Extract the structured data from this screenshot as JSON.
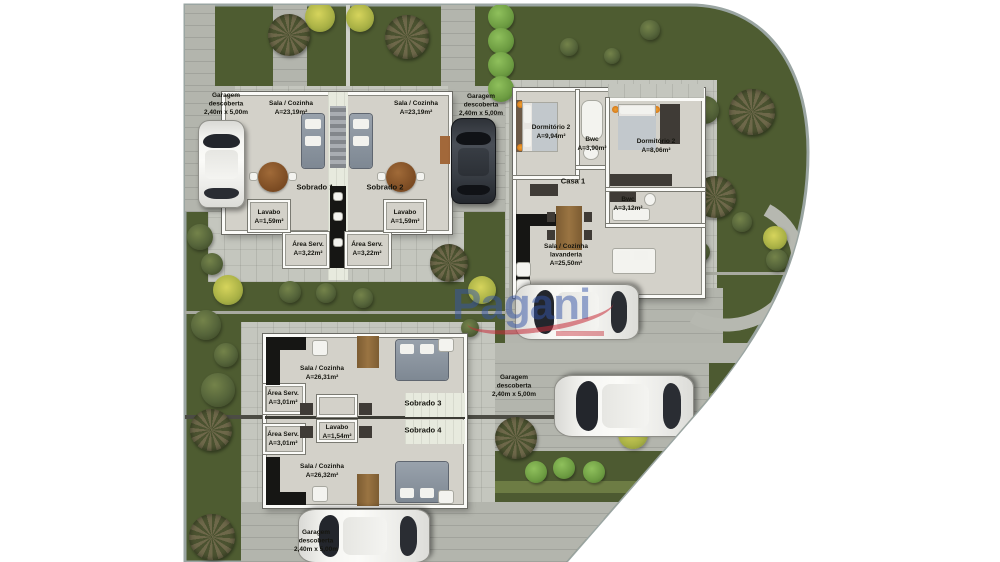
{
  "colors": {
    "lawn": "#4e5c31",
    "paving": "#c4c6be",
    "paving_dark": "#b3b5ad",
    "wall_white": "#fbfbf8",
    "counter_black": "#161614",
    "watermark_blue": "#3454a8",
    "watermark_red": "#c62c38"
  },
  "watermark": {
    "brand": "Pagani"
  },
  "garage_label": {
    "line1": "Garagem",
    "line2": "descoberta",
    "line3": "2,40m x 5,00m"
  },
  "top_building": {
    "unit1": {
      "name": "Sobrado 1",
      "room": "Sala / Cozinha",
      "room_area": "A=23,19m²",
      "lavabo": "Lavabo",
      "lavabo_area": "A=1,59m²",
      "service": "Área Serv.",
      "service_area": "A=3,22m²"
    },
    "unit2": {
      "name": "Sobrado 2",
      "room": "Sala / Cozinha",
      "room_area": "A=23,19m²",
      "lavabo": "Lavabo",
      "lavabo_area": "A=1,59m²",
      "service": "Área Serv.",
      "service_area": "A=3,22m²"
    }
  },
  "casa1": {
    "name": "Casa 1",
    "bedroom_left": {
      "room": "Dormitório 2",
      "area": "A=9,94m²"
    },
    "bathroom_top": {
      "room": "Bwc",
      "area": "A=3,90m²"
    },
    "bedroom_right": {
      "room": "Dormitório 2",
      "area": "A=8,06m²"
    },
    "bathroom_right": {
      "room": "Bwc",
      "area": "A=3,12m²"
    },
    "living": {
      "room": "Sala / Cozinha",
      "room_line2": "lavanderia",
      "area": "A=25,50m²"
    }
  },
  "bottom_building": {
    "unit3": {
      "name": "Sobrado 3",
      "room": "Sala / Cozinha",
      "room_area": "A=26,31m²",
      "service": "Área Serv.",
      "service_area": "A=3,01m²"
    },
    "unit4": {
      "name": "Sobrado 4",
      "room": "Sala / Cozinha",
      "room_area": "A=26,32m²",
      "service": "Área Serv.",
      "service_area": "A=3,01m²"
    },
    "lavabo": "Lavabo",
    "lavabo_area": "A=1,54m²"
  }
}
